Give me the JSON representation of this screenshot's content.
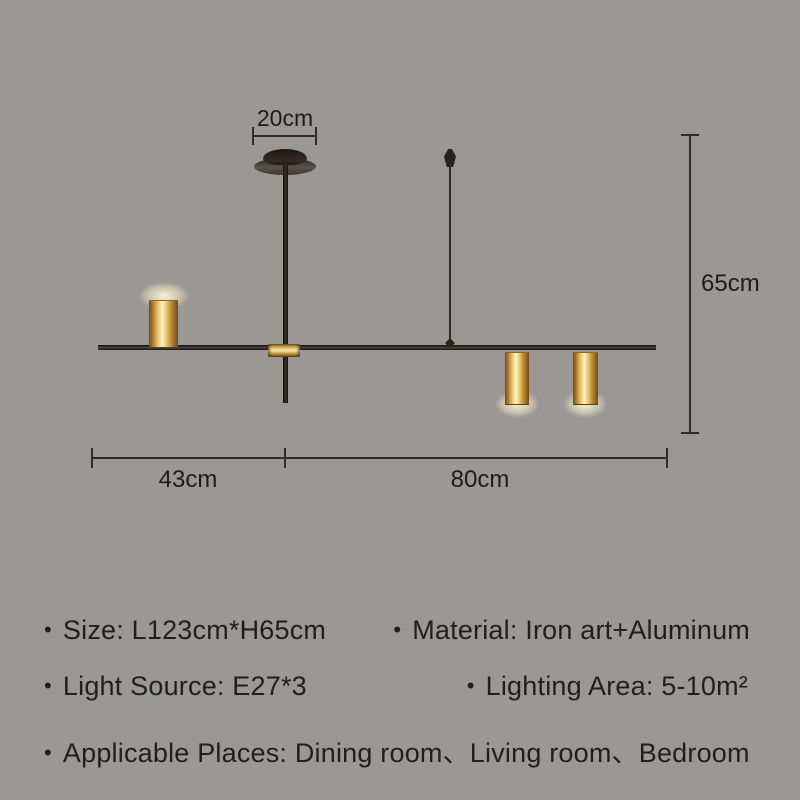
{
  "image": {
    "background_color": "#9a9795",
    "line_color": "#2e2d2c",
    "text_color": "#1f1f1f",
    "brass_color": "#c9973f",
    "lamp_color": "#1a1815"
  },
  "diagram": {
    "canopy_width_label": "20cm",
    "height_label": "65cm",
    "left_span_label": "43cm",
    "right_span_label": "80cm"
  },
  "specs": {
    "bullet": "•",
    "rows": [
      {
        "left": "Size: L123cm*H65cm",
        "right": "Material: Iron art+Aluminum"
      },
      {
        "left": "Light Source: E27*3",
        "right": "Lighting Area: 5-10m²"
      },
      {
        "left": "Applicable Places: Dining room、Living room、Bedroom",
        "right": ""
      }
    ]
  }
}
